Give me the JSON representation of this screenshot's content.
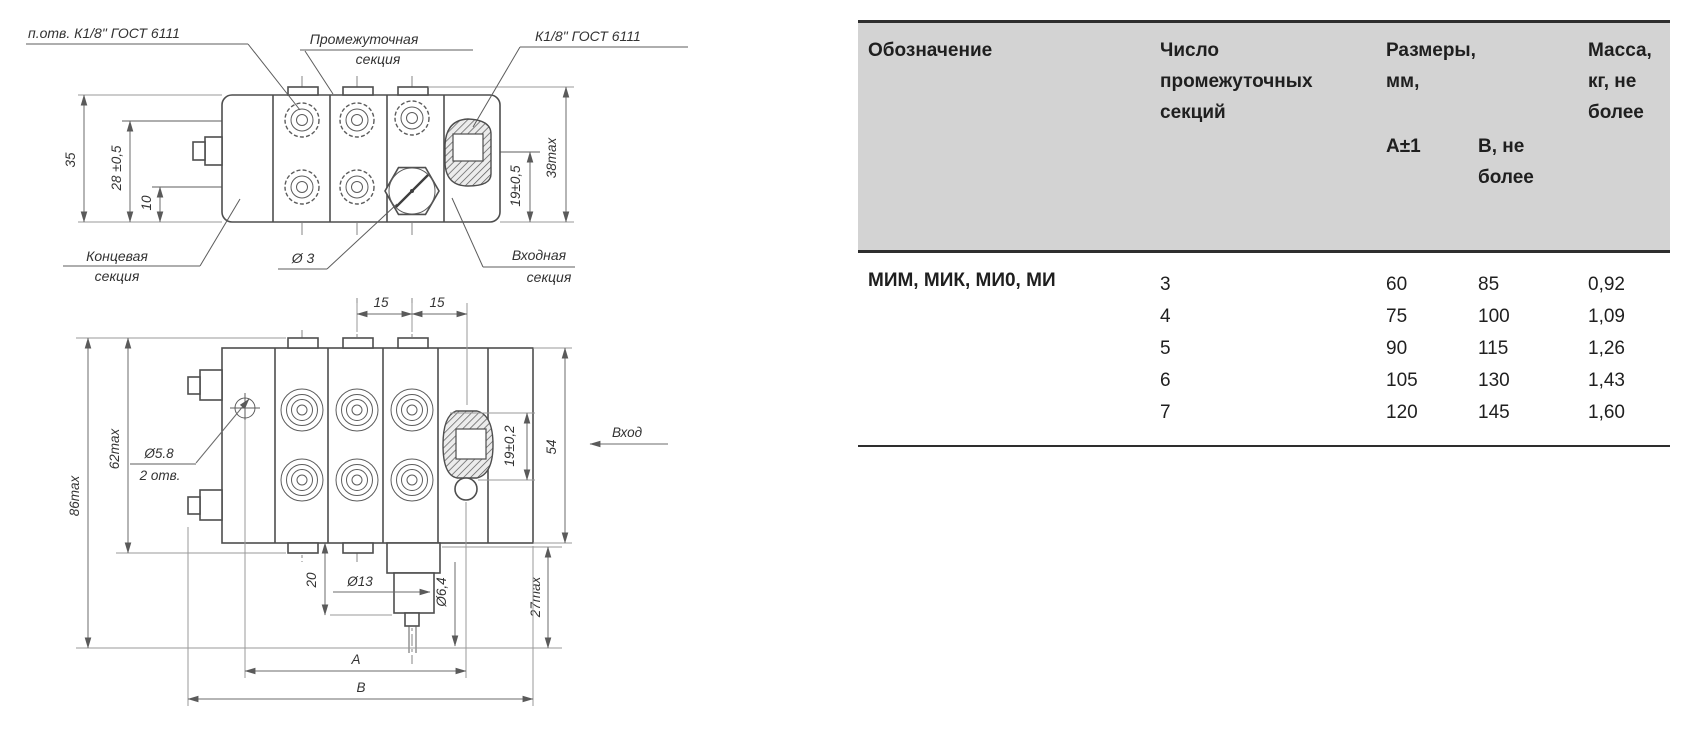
{
  "drawing": {
    "top_view": {
      "labels": {
        "tapped_hole": "п.отв. К1/8\" ГОСТ 6111",
        "intermediate_1": "Промежуточная",
        "intermediate_2": "секция",
        "thread": "К1/8\" ГОСТ 6111",
        "end_1": "Концевая",
        "end_2": "секция",
        "hole_d3": "Ø 3",
        "inlet_1": "Входная",
        "inlet_2": "секция"
      },
      "dims": {
        "h35": "35",
        "h28": "28 ±0,5",
        "h10": "10",
        "h19": "19±0,5",
        "h38": "38max"
      }
    },
    "bottom_view": {
      "dims": {
        "w15_left": "15",
        "w15_right": "15",
        "h62": "62max",
        "h86": "86max",
        "hole_d58_1": "Ø5.8",
        "hole_d58_2": "2 отв.",
        "h19": "19±0,2",
        "h54": "54",
        "inlet_arrow": "Вход",
        "h20": "20",
        "d13": "Ø13",
        "d64": "Ø6,4",
        "h27": "27max",
        "dim_a": "A",
        "dim_b": "B"
      }
    }
  },
  "table": {
    "headers": {
      "designation": "Обозначение",
      "sections_count": "Число промежуточных секций",
      "dimensions": "Размеры, мм,",
      "col_a": "A±1",
      "col_b": "B, не более",
      "mass": "Масса, кг, не более"
    },
    "designation_value": "МИМ, МИК, МИ0, МИ",
    "rows": [
      {
        "sections": "3",
        "a": "60",
        "b": "85",
        "mass": "0,92"
      },
      {
        "sections": "4",
        "a": "75",
        "b": "100",
        "mass": "1,09"
      },
      {
        "sections": "5",
        "a": "90",
        "b": "115",
        "mass": "1,26"
      },
      {
        "sections": "6",
        "a": "105",
        "b": "130",
        "mass": "1,43"
      },
      {
        "sections": "7",
        "a": "120",
        "b": "145",
        "mass": "1,60"
      }
    ]
  },
  "colors": {
    "table_header_bg": "#d3d3d3",
    "rule": "#2e2e2e",
    "line": "#4e4e4e"
  }
}
